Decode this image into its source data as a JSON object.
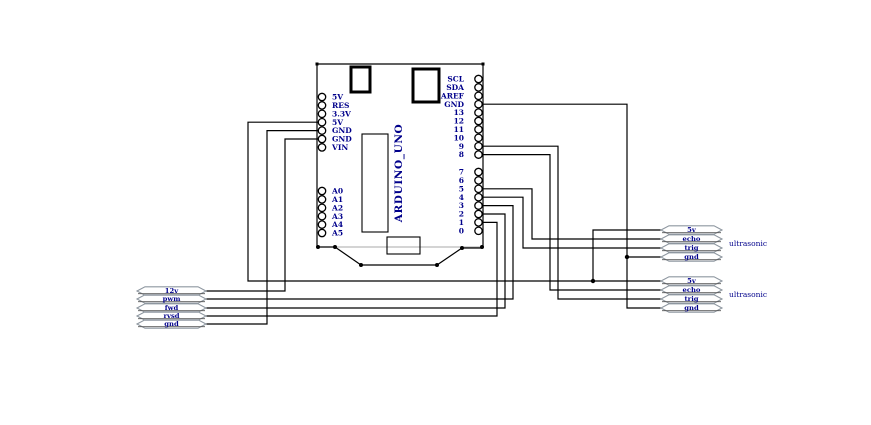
{
  "arduino": {
    "name": "ARDUINO_UNO",
    "left_power_pins": [
      "5V",
      "RES",
      "3.3V",
      "5V",
      "GND",
      "GND",
      "VIN"
    ],
    "left_analog_pins": [
      "A0",
      "A1",
      "A2",
      "A3",
      "A4",
      "A5"
    ],
    "right_top_pins": [
      "SCL",
      "SDA",
      "AREF",
      "GND",
      "13",
      "12",
      "11",
      "10",
      "9",
      "8"
    ],
    "right_bottom_pins": [
      "7",
      "6",
      "5",
      "4",
      "3",
      "2",
      "1",
      "0"
    ]
  },
  "motor_terminals": [
    "12v",
    "pwm",
    "fwd",
    "rvsd",
    "gnd"
  ],
  "ultrasonic_sensors": [
    {
      "label": "ultrasonic",
      "pins": [
        "5v",
        "echo",
        "trig",
        "gnd"
      ]
    },
    {
      "label": "ultrasonic",
      "pins": [
        "5v",
        "echo",
        "trig",
        "gnd"
      ]
    }
  ],
  "colors": {
    "wire": "#000000",
    "label": "#00008b",
    "terminal_outline": "#8e97a0",
    "terminal_baseline": "#555555",
    "board_bottom_edge": "#aaaaaa"
  }
}
